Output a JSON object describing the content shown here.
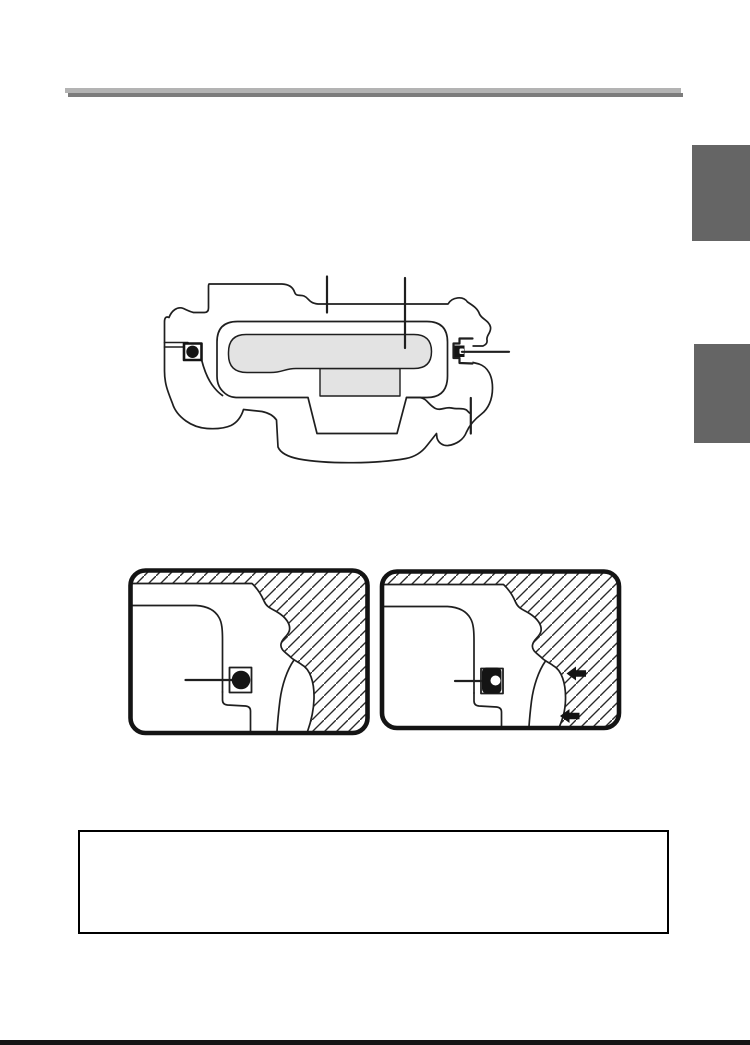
{
  "document": {
    "kind": "scanned-manual-page",
    "background": "#ffffff"
  },
  "header_rule": {
    "light_color": "#b3b3b3",
    "dark_color": "#7c7c7c"
  },
  "side_tabs": {
    "color": "#656565",
    "items": [
      {
        "name": "page-edge-tab-upper"
      },
      {
        "name": "page-edge-tab-lower"
      }
    ]
  },
  "main_figure": {
    "name": "camera-top-cross-section-diagram",
    "line_color": "#1f1f1f",
    "body_fill": "#ffffff",
    "gasket_fill": "#e3e3e3",
    "callout_count": 4,
    "parts": [
      "camera-body-outline",
      "gasket-channel",
      "gasket",
      "center-block",
      "left-strap-eyelet",
      "right-strap-eyelet"
    ]
  },
  "detail_panels": {
    "line_color": "#1f1f1f",
    "hatch_color": "#2a2a2a",
    "panels": [
      {
        "name": "eyelet-detail-left",
        "marker": "round-eyelet",
        "arrow_count": 0
      },
      {
        "name": "eyelet-detail-right",
        "marker": "clip-inserted",
        "arrow_count": 2
      }
    ]
  },
  "note_box": {
    "border_color": "#000000",
    "text": ""
  },
  "footer_bar": {
    "color": "#151515"
  }
}
